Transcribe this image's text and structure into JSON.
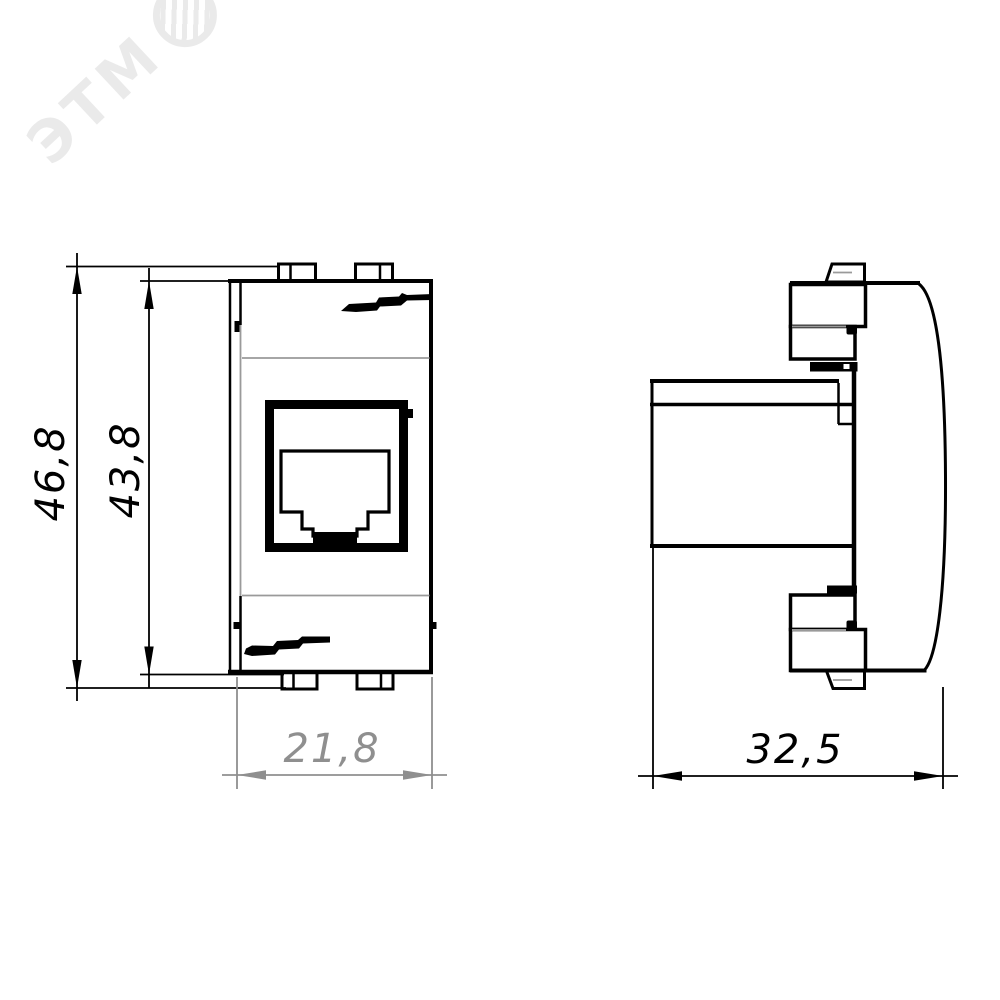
{
  "watermark": {
    "text": "ЭТМ"
  },
  "dimensions": {
    "overall_height": {
      "label": "46,8"
    },
    "body_height": {
      "label": "43,8"
    },
    "front_width": {
      "label": "21,8"
    },
    "side_depth": {
      "label": "32,5"
    }
  },
  "colors": {
    "line": "#000000",
    "dim_gray": "#8f8f8f",
    "seam_gray": "#9a9a9a",
    "background": "#ffffff",
    "watermark": "rgba(0,0,0,0.08)"
  }
}
